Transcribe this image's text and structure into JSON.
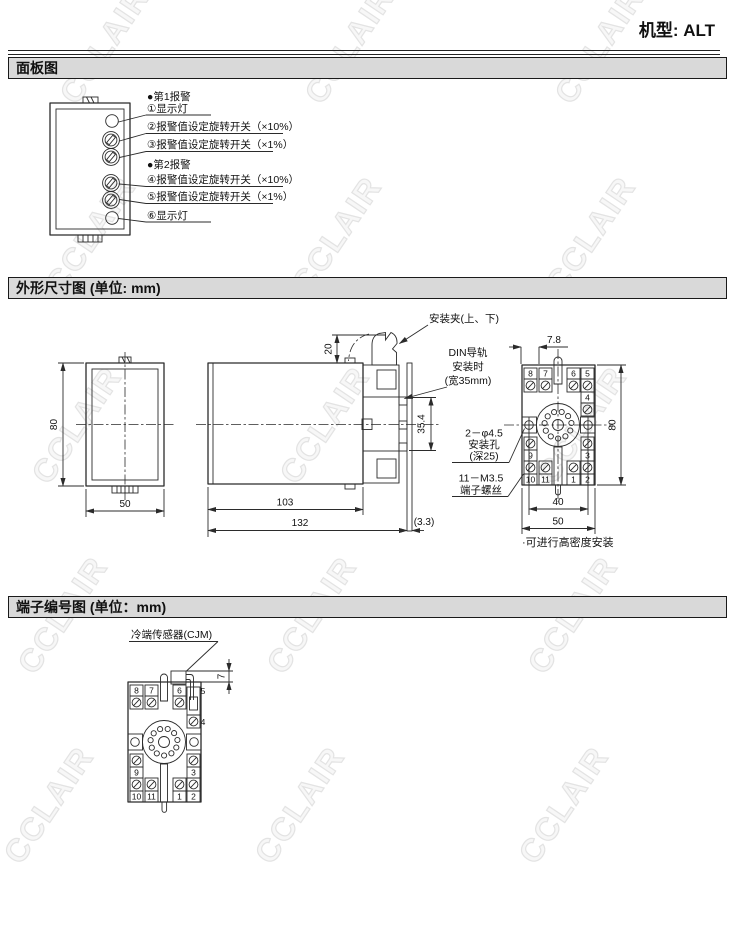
{
  "page": {
    "model_label": "机型: ALT",
    "watermark": "CCLAIR"
  },
  "sections": {
    "panel": "面板图",
    "outline": "外形尺寸图 (单位: mm)",
    "terminal": "端子编号图 (单位：mm)"
  },
  "panel": {
    "alarm1": "●第1报警",
    "lamp1": "①显示灯",
    "sw2": "②报警值设定旋转开关（×10%）",
    "sw3": "③报警值设定旋转开关（×1%）",
    "alarm2": "●第2报警",
    "sw4": "④报警值设定旋转开关（×10%）",
    "sw5": "⑤报警值设定旋转开关（×1%）",
    "lamp6": "⑥显示灯"
  },
  "outline": {
    "front_height": "80",
    "front_width": "50",
    "body_length": "103",
    "total_length": "132",
    "clip_height": "20",
    "rail_height": "35.4",
    "plate_gap": "(3.3)",
    "clip_label": "安装夹(上、下)",
    "din_label": {
      "l1": "DIN导轨",
      "l2": "安装时",
      "l3": "(宽35mm)"
    },
    "hole_label": {
      "l1": "2－φ4.5",
      "l2": "安装孔",
      "l3": "(深25)"
    },
    "screw_label": {
      "l1": "11－M3.5",
      "l2": "端子螺丝"
    },
    "socket_offset": "7.8",
    "socket_height": "80",
    "hole_span": "40",
    "socket_width": "50",
    "note": "·可进行高密度安装"
  },
  "terminal_numbers": {
    "n1": "1",
    "n2": "2",
    "n3": "3",
    "n4": "4",
    "n5": "5",
    "n6": "6",
    "n7": "7",
    "n8": "8",
    "n9": "9",
    "n10": "10",
    "n11": "11"
  },
  "terminal": {
    "sensor_label": "冷端传感器(CJM)",
    "sensor_height": "7"
  }
}
